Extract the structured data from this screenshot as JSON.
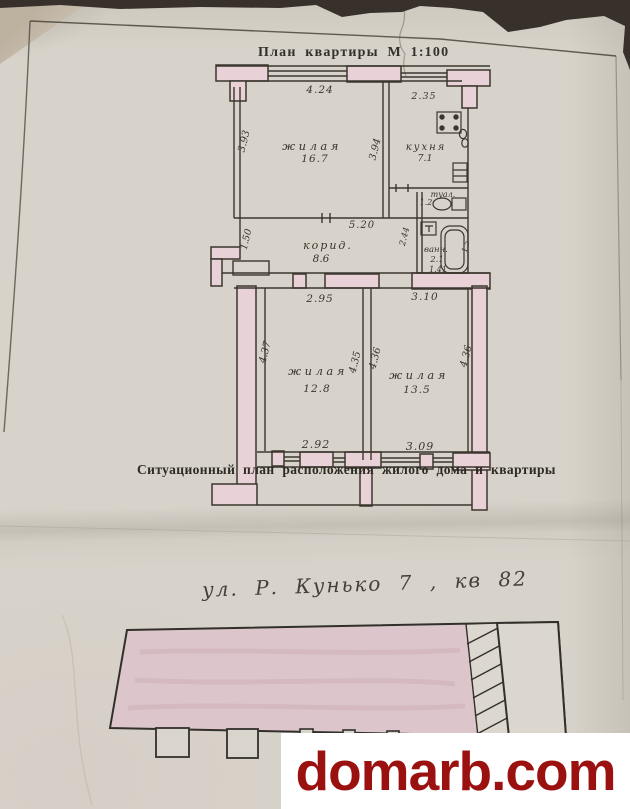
{
  "header": {
    "title": "План квартиры М 1:100"
  },
  "floor_plan": {
    "rooms": {
      "living1": {
        "name": "жилая",
        "area": "16.7"
      },
      "kitchen": {
        "name": "кухня",
        "area": "7.1"
      },
      "toilet": {
        "name": "туал.",
        "area": "1.2"
      },
      "bath": {
        "name": "ванн.",
        "area": "2.1",
        "note": "1.41"
      },
      "corridor": {
        "name": "корид.",
        "area": "8.6"
      },
      "living2": {
        "name": "жилая",
        "area": "12.8"
      },
      "living3": {
        "name": "жилая",
        "area": "13.5"
      }
    },
    "dims": {
      "living1_top": "4.24",
      "kitchen_top": "2.35",
      "living1_left": "3.93",
      "living1_right": "3.94",
      "corridor_top": "5.20",
      "entry_left": "1.50",
      "bath_left": "2.44",
      "bath_right": "1.5",
      "living2_top": "2.95",
      "living3_top": "3.10",
      "living2_left": "4.37",
      "living2_right": "4.35",
      "living3_left": "4.36",
      "living3_right": "4.36",
      "living2_bottom": "2.92",
      "living3_bottom": "3.09"
    }
  },
  "caption": {
    "text": "Ситуационный план расположения жилого дома и квартиры"
  },
  "handwriting": {
    "text": "ул. Р. Кунько 7 , кв 82"
  },
  "watermark": {
    "text": "domarb.com",
    "color": "#9b1110",
    "background": "#ffffff"
  },
  "colors": {
    "paper": "#d7d3ca",
    "wall_fill": "#e8d2d7",
    "ink": "#3b362e",
    "photo_background": "#38302a",
    "building_fill": "#dcc6cc"
  }
}
